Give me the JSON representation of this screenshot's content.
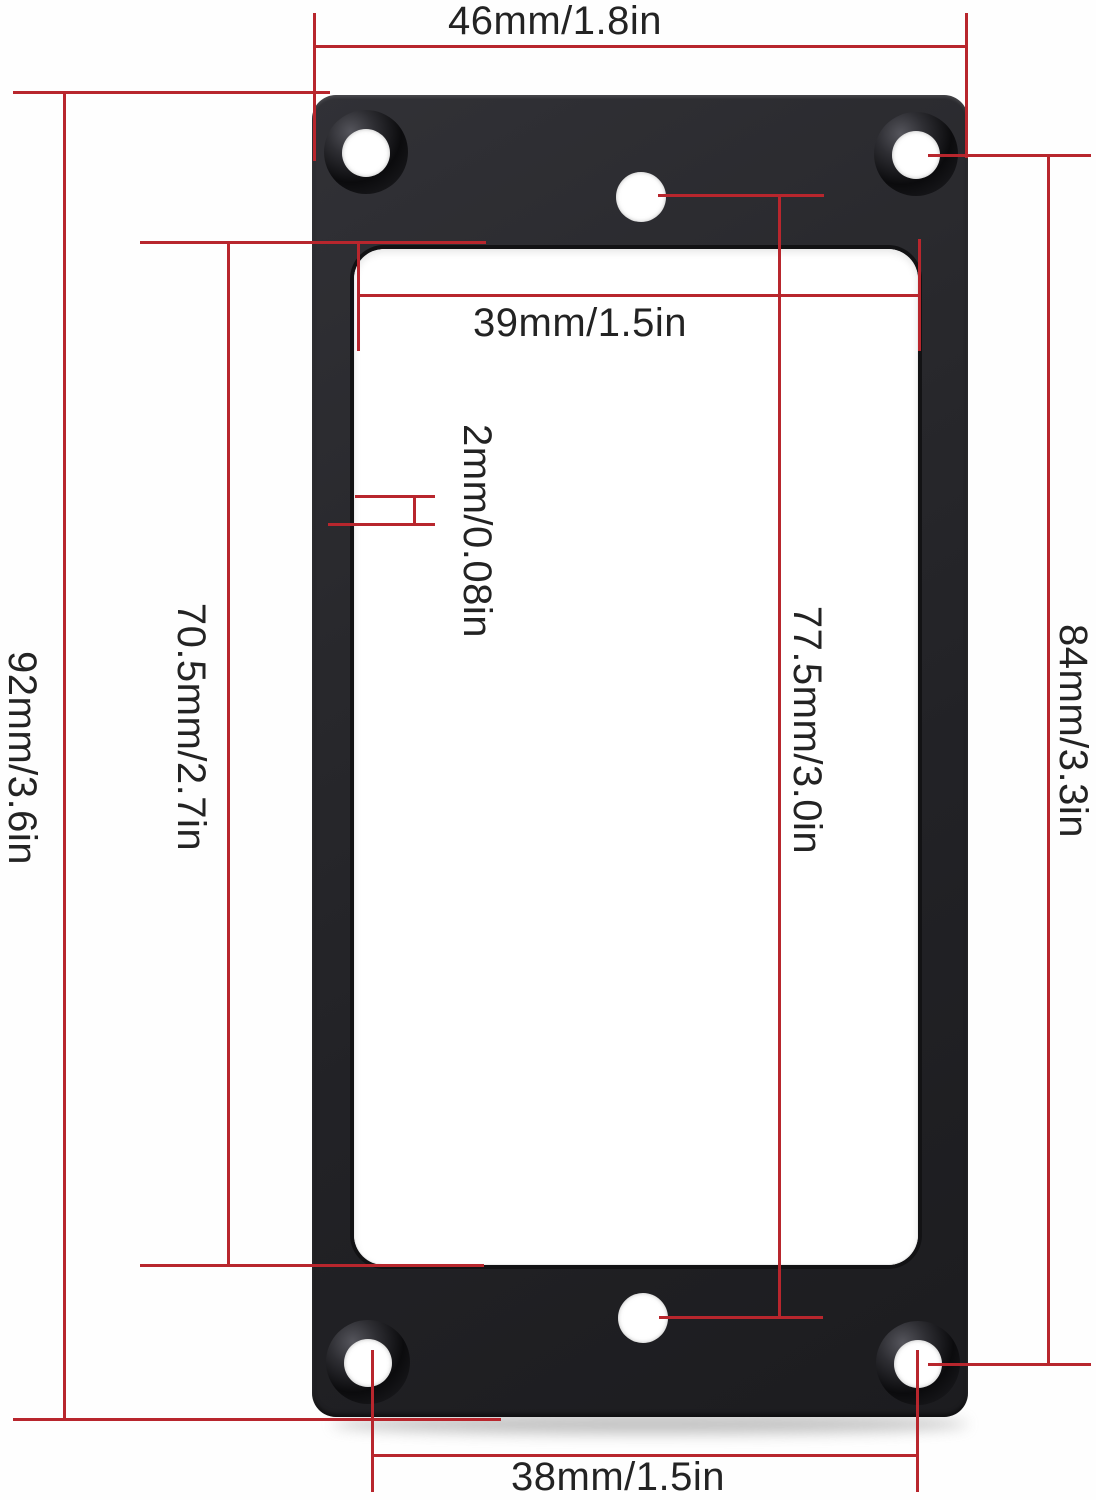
{
  "diagram": {
    "kind": "product-dimension-diagram",
    "subject": "flat black humbucker pickup mounting ring, top view with red dimension lines"
  },
  "dimensions": {
    "outer_width": {
      "label": "46mm/1.8in",
      "orientation": "horizontal",
      "position": "top"
    },
    "inner_width": {
      "label": "39mm/1.5in",
      "orientation": "horizontal",
      "position": "inside-top"
    },
    "rim_thickness": {
      "label": "2mm/0.08in",
      "orientation": "vertical",
      "position": "left-rail"
    },
    "inner_height": {
      "label": "70.5mm/2.7in",
      "orientation": "vertical",
      "position": "left-inner"
    },
    "outer_height": {
      "label": "92mm/3.6in",
      "orientation": "vertical",
      "position": "far-left"
    },
    "center_hole_spacing": {
      "label": "77.5mm/3.0in",
      "orientation": "vertical",
      "position": "center-right"
    },
    "screw_hole_height": {
      "label": "84mm/3.3in",
      "orientation": "vertical",
      "position": "far-right"
    },
    "screw_hole_width": {
      "label": "38mm/1.5in",
      "orientation": "horizontal",
      "position": "bottom"
    }
  },
  "colors": {
    "dimension_line": "#b8262d",
    "frame_black": "#242427",
    "background": "#fefefe",
    "label_text": "#232323"
  }
}
